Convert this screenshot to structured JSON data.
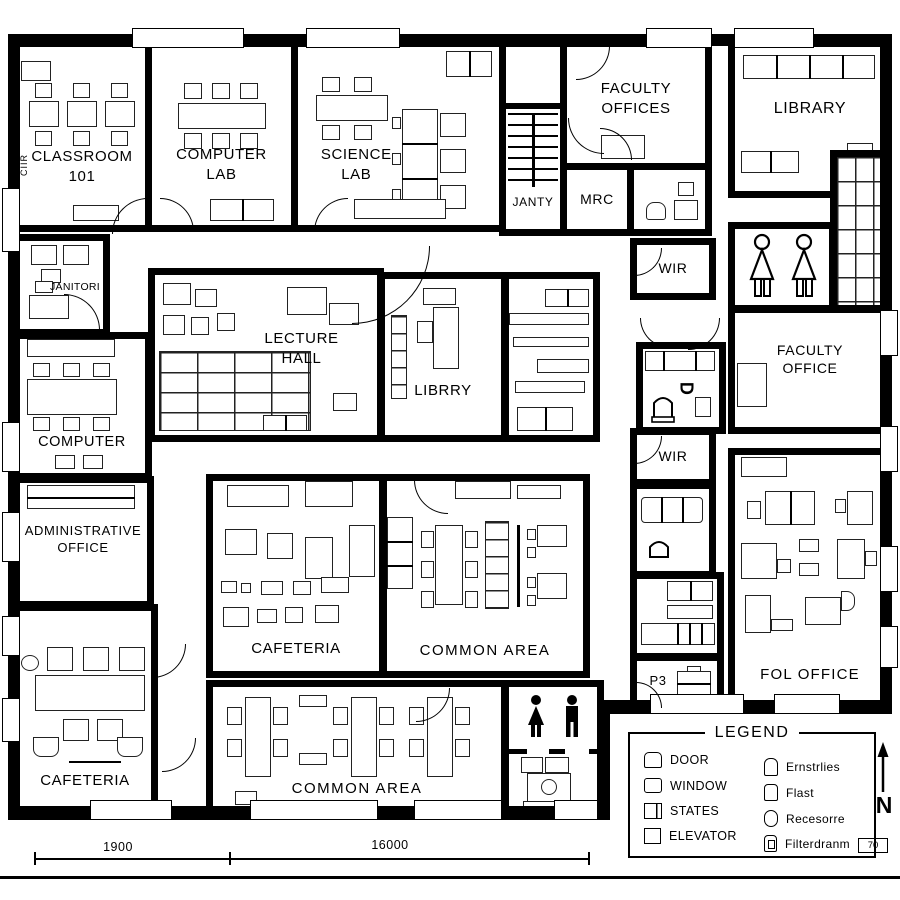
{
  "side_label": "CIIR",
  "rooms": {
    "classroom": {
      "l1": "CLASSROOM",
      "l2": "101"
    },
    "computer_lab": {
      "l1": "COMPUTER",
      "l2": "LAB"
    },
    "science_lab": {
      "l1": "SCIENCE",
      "l2": "LAB"
    },
    "janty": {
      "l1": "JANTY"
    },
    "mrc": {
      "l1": "MRC"
    },
    "faculty_offices": {
      "l1": "FACULTY",
      "l2": "OFFICES"
    },
    "library": {
      "l1": "LIBRARY"
    },
    "wir_upper": {
      "l1": "WIR"
    },
    "faculty_office": {
      "l1": "FACULTY",
      "l2": "OFFICE"
    },
    "d_room": {
      "l1": "D"
    },
    "janitori": {
      "l1": "JANITORI"
    },
    "computer_room": {
      "l1": "COMPUTER"
    },
    "lecture_hall": {
      "l1": "LECTURE",
      "l2": "HALL"
    },
    "librry": {
      "l1": "LIBRRY"
    },
    "admin_office": {
      "l1": "ADMINISTRATIVE",
      "l2": "OFFICE"
    },
    "cafeteria_left": {
      "l1": "CAFETERIA"
    },
    "cafeteria_center": {
      "l1": "CAFETERIA"
    },
    "common_area_center": {
      "l1": "COMMON AREA"
    },
    "common_area_bottom": {
      "l1": "COMMON AREA"
    },
    "wir_lower": {
      "l1": "WIR"
    },
    "p3": {
      "l1": "P3"
    },
    "fol_office": {
      "l1": "FOL OFFICE"
    }
  },
  "dimensions": {
    "d1": "1900",
    "d2": "16000"
  },
  "legend": {
    "title": "LEGEND",
    "north": "N",
    "corner_tag": "70",
    "left_items": [
      {
        "label": "DOOR"
      },
      {
        "label": "WINDOW"
      },
      {
        "label": "STATES"
      },
      {
        "label": "ELEVATOR"
      }
    ],
    "right_items": [
      {
        "label": "Ernstrlies"
      },
      {
        "label": "Flast"
      },
      {
        "label": "Recesorre"
      },
      {
        "label": "Filterdranm"
      }
    ]
  },
  "colors": {
    "wall": "#000000",
    "background": "#ffffff"
  }
}
